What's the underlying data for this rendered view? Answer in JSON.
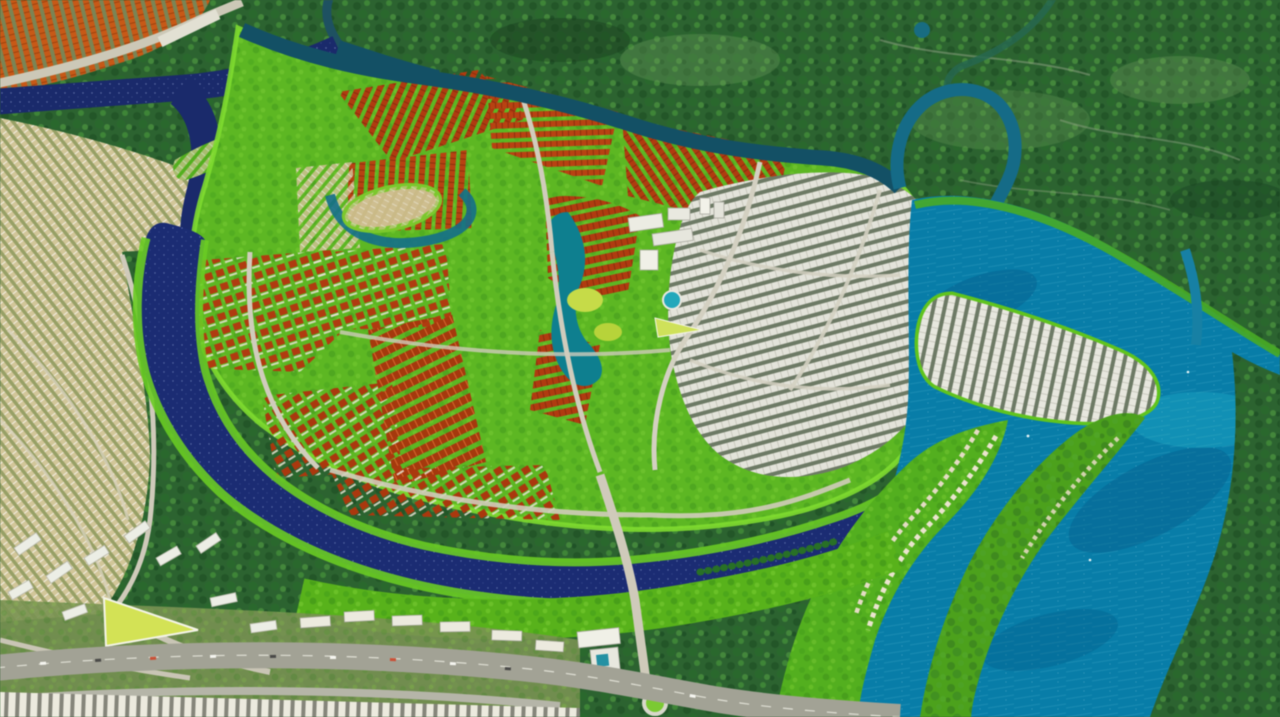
{
  "scene": {
    "description": "Aerial 3D rendering of a riverside master-planned township: winding navy and turquoise rivers around a central island of red-roofed villa districts and white townhouse quarters, a lagoon and golf amenity core, bright green riverbank parklands, peninsulas with villa rows, an existing orange-roofed town at top left, forested floodplain beyond, and a foreground boulevard with a roundabout and low-rise suburb",
    "regions": [
      "orange-roof existing town",
      "forested floodplain",
      "navy river channel",
      "north river channel with meander",
      "turquoise river",
      "central island parkland",
      "red-roof villa districts",
      "red terraced rows",
      "white townhouse district",
      "central commercial cluster",
      "lagoon and golf park",
      "white housing peninsula",
      "green peninsulas with villa rows",
      "riverbank green band",
      "bridge road and roundabout",
      "foreground boulevard with shophouses",
      "tan low-rise suburb",
      "white apartment blocks",
      "lime wedge park"
    ],
    "palette": {
      "forest_green": "#2f6233",
      "canopy_dark": "#1e4a22",
      "island_green": "#61b52c",
      "bank_green": "#6fc92e",
      "navy_river": "#1c2c6e",
      "channel_teal": "#174f63",
      "turquoise_river": "#0f7ba3",
      "lake_teal": "#157d8c",
      "red_roof": "#a93d15",
      "orange_roof": "#c05a1d",
      "white_building": "#e7e7df",
      "tan_housing": "#d1c69c",
      "road_gray": "#c9c5b6",
      "boulevard_gray": "#a2a296",
      "lime_feature": "#d3e15e"
    }
  }
}
